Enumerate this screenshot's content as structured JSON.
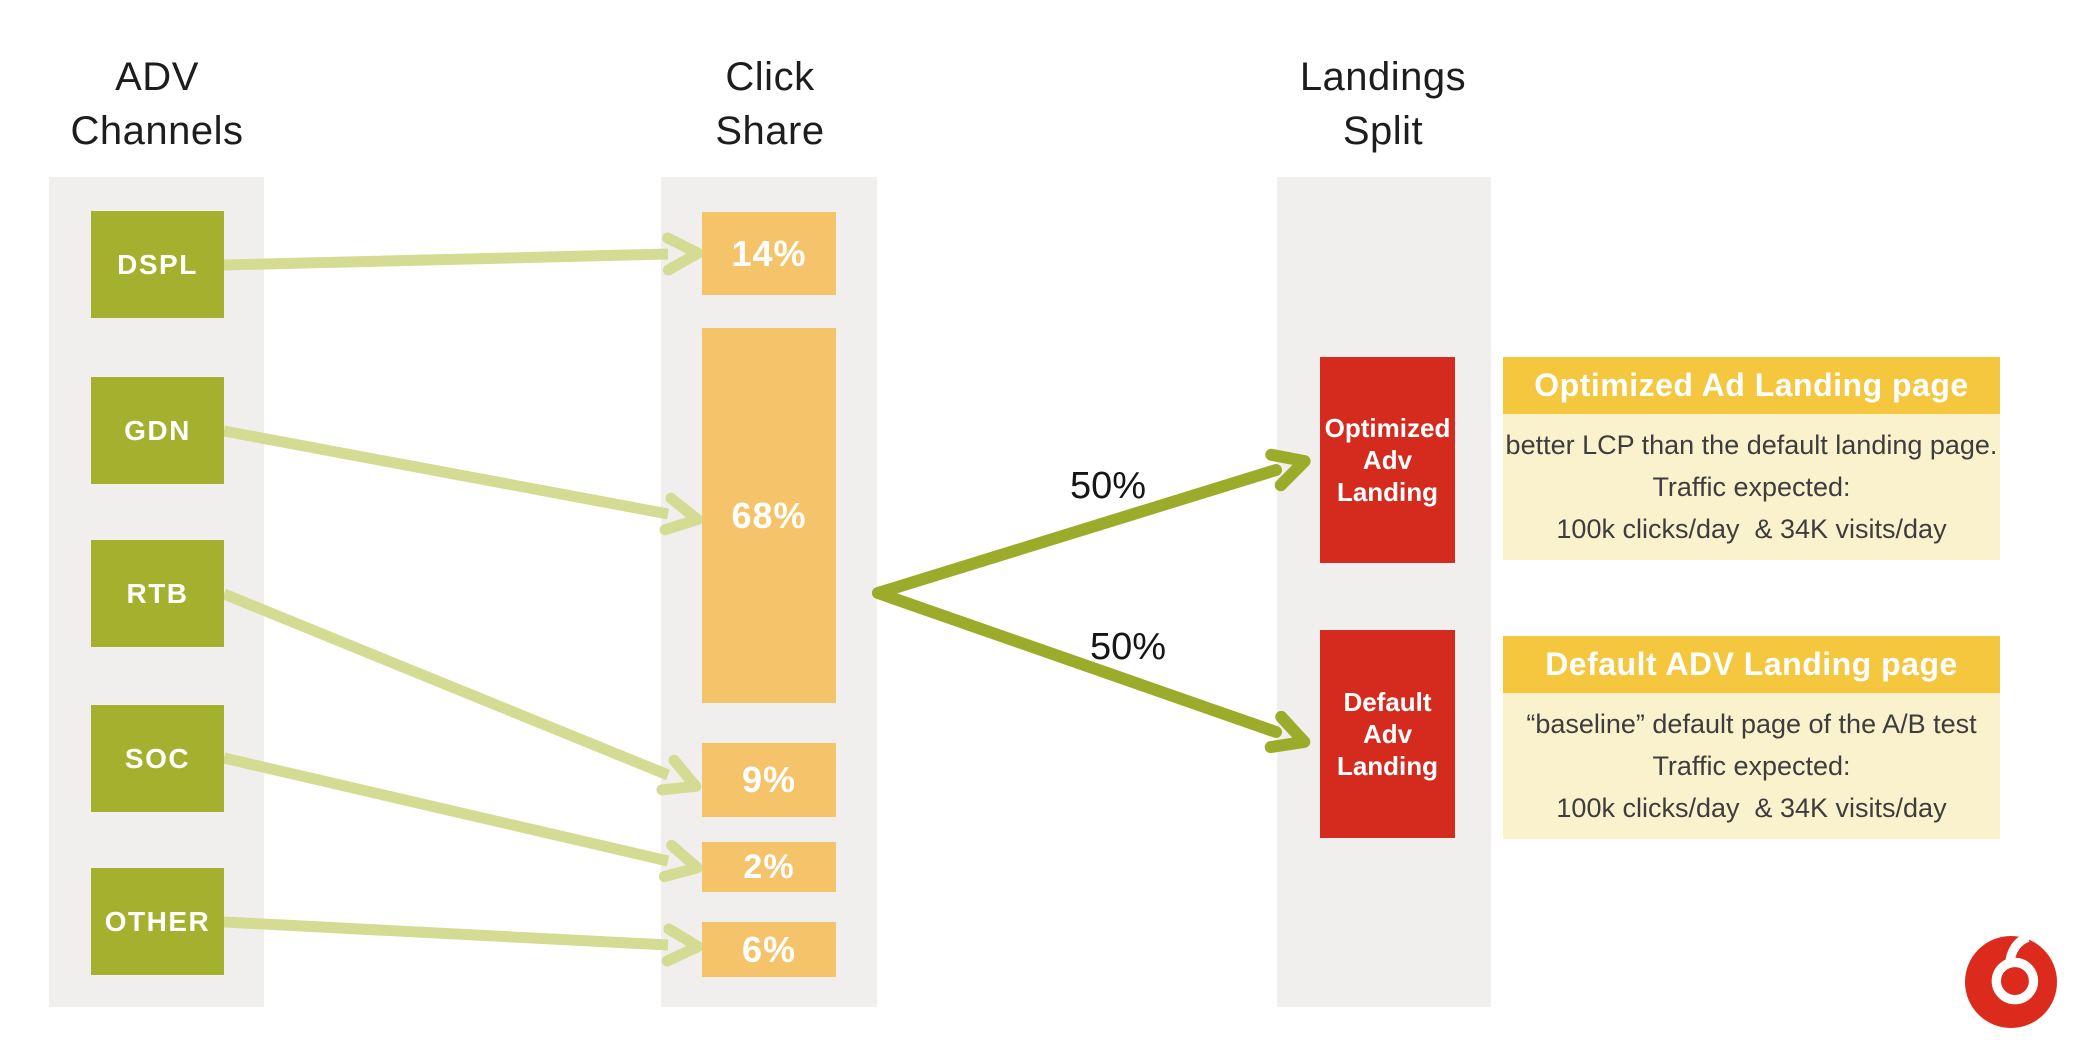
{
  "columns": {
    "adv_channels": {
      "header": "ADV\nChannels"
    },
    "click_share": {
      "header": "Click\nShare"
    },
    "landings_split": {
      "header": "Landings\nSplit"
    }
  },
  "channels": [
    {
      "label": "DSPL"
    },
    {
      "label": "GDN"
    },
    {
      "label": "RTB"
    },
    {
      "label": "SOC"
    },
    {
      "label": "OTHER"
    }
  ],
  "click_shares": [
    {
      "label": "14%",
      "value": 14
    },
    {
      "label": "68%",
      "value": 68
    },
    {
      "label": "9%",
      "value": 9
    },
    {
      "label": "2%",
      "value": 2
    },
    {
      "label": "6%",
      "value": 6
    }
  ],
  "flows": [
    {
      "from": "DSPL",
      "to": "14%"
    },
    {
      "from": "GDN",
      "to": "68%"
    },
    {
      "from": "RTB",
      "to": "9%"
    },
    {
      "from": "SOC",
      "to": "2%"
    },
    {
      "from": "OTHER",
      "to": "6%"
    }
  ],
  "split": {
    "upper": {
      "label": "50%",
      "value": 50,
      "target": "Optimized Adv Landing"
    },
    "lower": {
      "label": "50%",
      "value": 50,
      "target": "Default Adv Landing"
    }
  },
  "landings": [
    {
      "label": "Optimized\nAdv\nLanding"
    },
    {
      "label": "Default\nAdv\nLanding"
    }
  ],
  "callouts": [
    {
      "title": "Optimized Ad Landing page",
      "body": "better LCP than the default landing page.\nTraffic expected:\n100k clicks/day  & 34K visits/day"
    },
    {
      "title": "Default ADV Landing page",
      "body": "“baseline” default page of the A/B test\nTraffic expected:\n100k clicks/day  & 34K visits/day"
    }
  ],
  "logo": {
    "name": "vodafone-speechmark"
  },
  "colors": {
    "channel_green": "#a5b02e",
    "light_arrow": "#d4db92",
    "dark_arrow": "#9bac2a",
    "share_orange": "#f5c36a",
    "landing_red": "#d52b1e",
    "callout_header_gold": "#f4c73e",
    "callout_body_cream": "#faf1cd",
    "column_gray": "#f0efee",
    "logo_red": "#dc2b1c",
    "text_dark": "#1d1d1d"
  }
}
